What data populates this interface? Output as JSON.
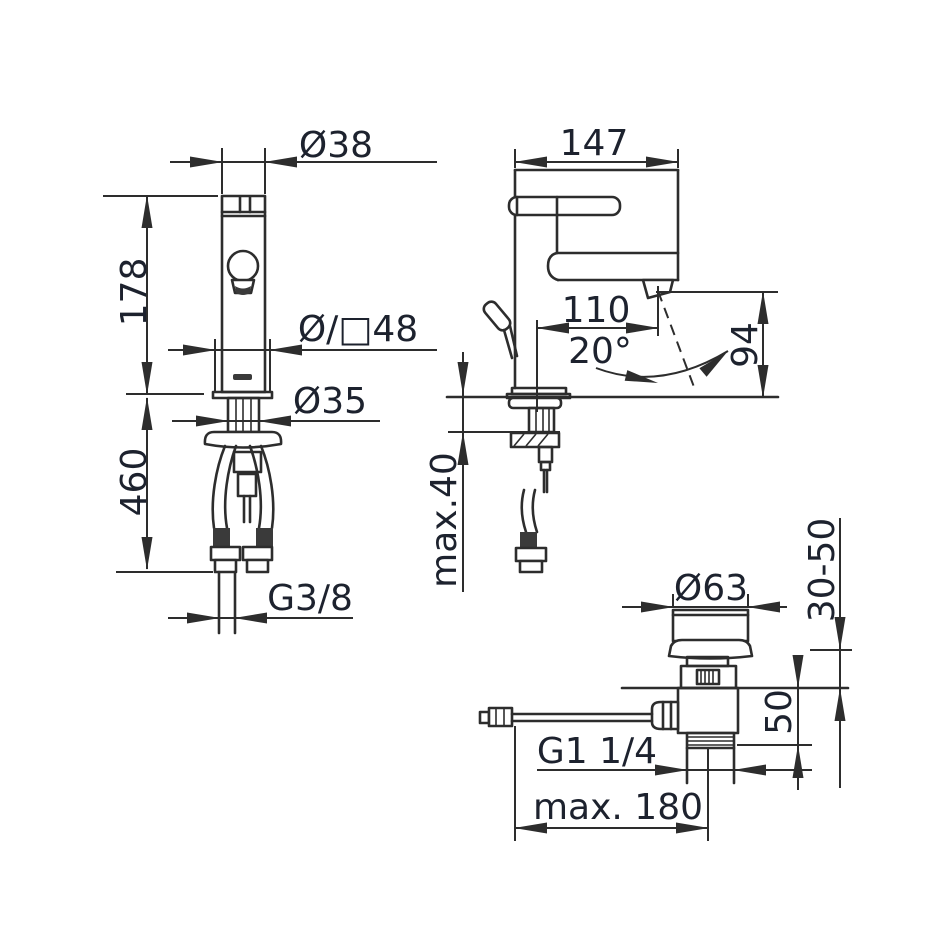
{
  "colors": {
    "line": "#2d2d2d",
    "text": "#1d222e",
    "background": "#ffffff"
  },
  "views": {
    "front": {
      "dim_spout_diameter": "Ø38",
      "dim_body_height": "178",
      "dim_base_width": "Ø/□48",
      "dim_shank_diameter": "Ø35",
      "dim_hose_length": "460",
      "dim_hose_thread": "G3/8"
    },
    "side": {
      "dim_overall_depth": "147",
      "dim_spout_reach": "110",
      "dim_spout_angle": "20°",
      "dim_spout_height": "94",
      "dim_deck_thickness": "max.40"
    },
    "drain": {
      "dim_plug_diameter": "Ø63",
      "dim_height_adjustment": "30-50",
      "dim_body_height": "50",
      "dim_outlet_thread": "G1 1/4",
      "dim_rod_length": "max. 180"
    }
  }
}
